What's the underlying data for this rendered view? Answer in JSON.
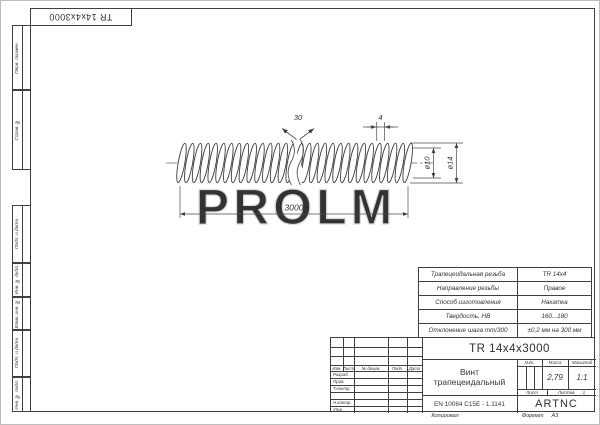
{
  "sheet": {
    "corner_designation": "TR 14x4x3000",
    "watermark": "PROLM",
    "side_labels": [
      "Перв. примен.",
      "Справ. №",
      "Подп. и дата",
      "Инв. № дубл.",
      "Взам. инв. №",
      "Подп. и дата",
      "Инв. № подл."
    ]
  },
  "drawing": {
    "angle": "30",
    "pitch": "4",
    "inner_diameter": "ø10",
    "outer_diameter": "ø14",
    "length": "3000"
  },
  "spec_table": {
    "rows": [
      {
        "label": "Трапецеидальная резьба",
        "value": "TR 14x4"
      },
      {
        "label": "Направление резьбы",
        "value": "Правое"
      },
      {
        "label": "Способ изготовления",
        "value": "Накатка"
      },
      {
        "label": "Твердость, HB",
        "value": "160...180"
      },
      {
        "label": "Отклонение шага mm/300",
        "value": "±0,2 мм на 300 мм"
      }
    ]
  },
  "title_block": {
    "designation": "TR 14x4x3000",
    "part_name_line1": "Винт",
    "part_name_line2": "трапецеидальный",
    "material": "EN 10084 C15E - 1.1141",
    "company": "ARTNC",
    "change_cols": [
      "Изм.",
      "Лист",
      "№ докум.",
      "Подп.",
      "Дата"
    ],
    "sign_rows": [
      "Разраб.",
      "Пров.",
      "Т.контр.",
      "",
      "Н.контр.",
      "Утв."
    ],
    "lit_label": "Лит.",
    "mass_label": "Масса",
    "scale_label": "Масштаб",
    "mass_value": "2,79",
    "scale_value": "1:1",
    "sheet_label": "Лист",
    "sheets_label": "Листов",
    "sheets_value": "1",
    "copied_label": "Копировал",
    "format_label": "Формат",
    "format_value": "A3"
  }
}
